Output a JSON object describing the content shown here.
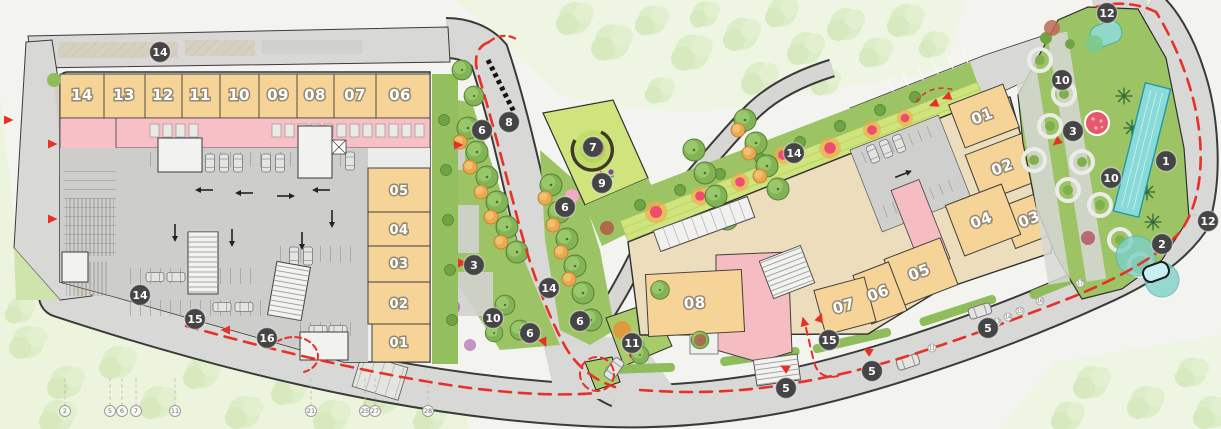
{
  "plan": {
    "left_building": {
      "top_units": [
        {
          "label": "14",
          "x": 82
        },
        {
          "label": "13",
          "x": 124
        },
        {
          "label": "12",
          "x": 163
        },
        {
          "label": "11",
          "x": 200
        },
        {
          "label": "10",
          "x": 239
        },
        {
          "label": "09",
          "x": 278
        },
        {
          "label": "08",
          "x": 315
        },
        {
          "label": "07",
          "x": 355
        },
        {
          "label": "06",
          "x": 400
        }
      ],
      "top_y": 100,
      "side_units": [
        {
          "label": "05",
          "y": 195
        },
        {
          "label": "04",
          "y": 234
        },
        {
          "label": "03",
          "y": 268
        },
        {
          "label": "02",
          "y": 308
        },
        {
          "label": "01",
          "y": 347
        }
      ],
      "side_x": 399
    },
    "right_building": {
      "units": [
        {
          "label": "01",
          "x": 984,
          "y": 121,
          "rot": -21
        },
        {
          "label": "02",
          "x": 1004,
          "y": 172,
          "rot": -21
        },
        {
          "label": "03",
          "x": 1031,
          "y": 224,
          "rot": -21
        },
        {
          "label": "04",
          "x": 983,
          "y": 225,
          "rot": -21
        },
        {
          "label": "05",
          "x": 921,
          "y": 277,
          "rot": -21
        },
        {
          "label": "06",
          "x": 880,
          "y": 298,
          "rot": -21
        },
        {
          "label": "07",
          "x": 845,
          "y": 311,
          "rot": -15
        },
        {
          "label": "08",
          "x": 695,
          "y": 308,
          "rot": -3
        }
      ]
    },
    "markers": [
      {
        "label": "14",
        "x": 160,
        "y": 52
      },
      {
        "label": "6",
        "x": 482,
        "y": 130
      },
      {
        "label": "8",
        "x": 509,
        "y": 122
      },
      {
        "label": "7",
        "x": 593,
        "y": 147
      },
      {
        "label": "9",
        "x": 602,
        "y": 183
      },
      {
        "label": "6",
        "x": 565,
        "y": 207
      },
      {
        "label": "3",
        "x": 474,
        "y": 265
      },
      {
        "label": "14",
        "x": 549,
        "y": 288
      },
      {
        "label": "10",
        "x": 493,
        "y": 318
      },
      {
        "label": "6",
        "x": 530,
        "y": 333
      },
      {
        "label": "6",
        "x": 580,
        "y": 321
      },
      {
        "label": "11",
        "x": 632,
        "y": 343
      },
      {
        "label": "14",
        "x": 140,
        "y": 295
      },
      {
        "label": "15",
        "x": 195,
        "y": 319
      },
      {
        "label": "16",
        "x": 267,
        "y": 338
      },
      {
        "label": "14",
        "x": 794,
        "y": 153
      },
      {
        "label": "15",
        "x": 829,
        "y": 340
      },
      {
        "label": "5",
        "x": 786,
        "y": 388
      },
      {
        "label": "5",
        "x": 872,
        "y": 371
      },
      {
        "label": "5",
        "x": 988,
        "y": 328
      },
      {
        "label": "10",
        "x": 1062,
        "y": 80
      },
      {
        "label": "3",
        "x": 1073,
        "y": 131
      },
      {
        "label": "10",
        "x": 1111,
        "y": 178
      },
      {
        "label": "1",
        "x": 1166,
        "y": 161
      },
      {
        "label": "2",
        "x": 1162,
        "y": 244
      },
      {
        "label": "12",
        "x": 1208,
        "y": 221
      },
      {
        "label": "12",
        "x": 1107,
        "y": 13
      }
    ],
    "road_bubbles": [
      {
        "label": "11",
        "x": 932,
        "y": 348
      },
      {
        "label": "13",
        "x": 997,
        "y": 322
      },
      {
        "label": "14",
        "x": 1008,
        "y": 317
      },
      {
        "label": "15",
        "x": 1020,
        "y": 311
      },
      {
        "label": "16",
        "x": 1040,
        "y": 301
      },
      {
        "label": "17",
        "x": 1080,
        "y": 283
      }
    ],
    "ref_bubbles": [
      {
        "label": "2",
        "x": 65
      },
      {
        "label": "5",
        "x": 110
      },
      {
        "label": "6",
        "x": 122
      },
      {
        "label": "7",
        "x": 136
      },
      {
        "label": "11",
        "x": 175
      },
      {
        "label": "21",
        "x": 311
      },
      {
        "label": "25",
        "x": 365
      },
      {
        "label": "27",
        "x": 375
      },
      {
        "label": "28",
        "x": 428
      }
    ],
    "ref_bubble_y": 411,
    "colors": {
      "accent_red": "#e73128",
      "unit_fill": "#f6d396",
      "corridor_pink": "#f6c0c6",
      "parking_gray": "#cdcdcb",
      "landscape_green": "#9cc465",
      "pool_teal": "#8adada",
      "marker_bg": "#454545",
      "road_gray": "#d8d8d6"
    }
  }
}
